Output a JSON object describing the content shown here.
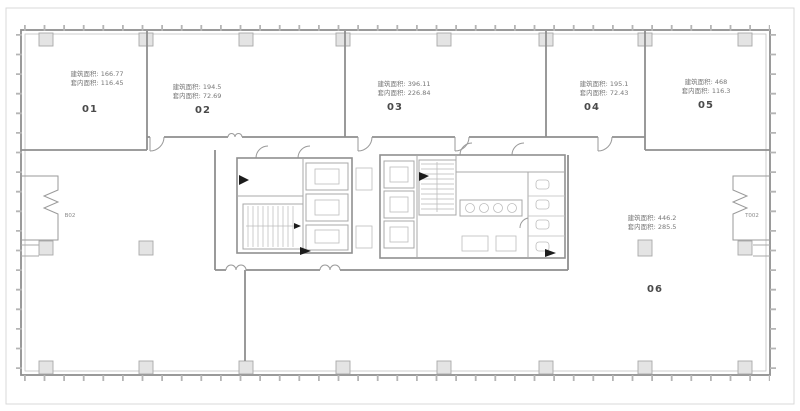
{
  "plan": {
    "title": "office-floor-plan",
    "units": [
      {
        "number": "01",
        "built_area": "建筑面积: 166.77",
        "inner_area": "套内面积: 116.45"
      },
      {
        "number": "02",
        "built_area": "建筑面积: 194.5",
        "inner_area": "套内面积: 72.69"
      },
      {
        "number": "03",
        "built_area": "建筑面积: 396.11",
        "inner_area": "套内面积: 226.84"
      },
      {
        "number": "04",
        "built_area": "建筑面积: 195.1",
        "inner_area": "套内面积: 72.43"
      },
      {
        "number": "05",
        "built_area": "建筑面积: 468",
        "inner_area": "套内面积: 116.3"
      },
      {
        "number": "06",
        "built_area": "建筑面积: 446.2",
        "inner_area": "套内面积: 285.5"
      }
    ],
    "wall_tags": {
      "left": "B02",
      "right": "T002"
    },
    "colors": {
      "wall": "#8f8f8f",
      "wall_light": "#c2c2c2",
      "column_fill": "#e4e4e4",
      "column_stroke": "#a8a8a8",
      "frame": "#d9d9d9",
      "area_text": "#777777",
      "unit_number": "#4a4a4a",
      "detail": "#bdbdbd",
      "marker": "#1c1c1c"
    }
  }
}
